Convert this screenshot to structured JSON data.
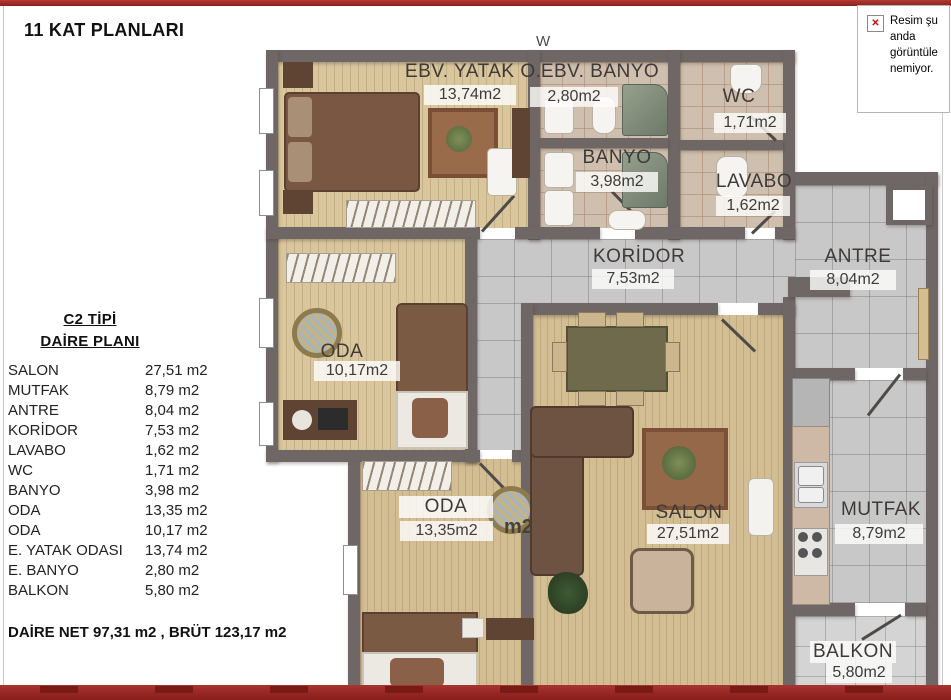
{
  "page": {
    "title": "11 KAT PLANLARI"
  },
  "broken_image_notice": {
    "text": "Resim şu anda görüntüle nemiyor.",
    "icon": "broken-image-x"
  },
  "info_panel": {
    "heading_line1": "C2 TİPİ",
    "heading_line2": "DAİRE PLANI",
    "rooms": [
      {
        "name": "SALON",
        "area": "27,51 m2"
      },
      {
        "name": "MUTFAK",
        "area": "8,79 m2"
      },
      {
        "name": "ANTRE",
        "area": "8,04 m2"
      },
      {
        "name": "KORİDOR",
        "area": "7,53 m2"
      },
      {
        "name": "LAVABO",
        "area": "1,62 m2"
      },
      {
        "name": "WC",
        "area": "1,71 m2"
      },
      {
        "name": "BANYO",
        "area": "3,98 m2"
      },
      {
        "name": "ODA",
        "area": "13,35 m2"
      },
      {
        "name": "ODA",
        "area": "10,17 m2"
      },
      {
        "name": "E. YATAK ODASI",
        "area": "13,74 m2"
      },
      {
        "name": "E. BANYO",
        "area": "2,80 m2"
      },
      {
        "name": "BALKON",
        "area": "5,80 m2"
      }
    ],
    "totals": "DAİRE NET 97,31 m2 , BRÜT 123,17 m2"
  },
  "plan": {
    "rooms": [
      {
        "name": "EBV. YATAK O.",
        "area": "13,74m2"
      },
      {
        "name": "EBV. BANYO",
        "area": "2,80m2"
      },
      {
        "name": "WC",
        "area": "1,71m2"
      },
      {
        "name": "BANYO",
        "area": "3,98m2"
      },
      {
        "name": "LAVABO",
        "area": "1,62m2"
      },
      {
        "name": "KORİDOR",
        "area": "7,53m2"
      },
      {
        "name": "ANTRE",
        "area": "8,04m2"
      },
      {
        "name": "ODA",
        "area": "10,17m2"
      },
      {
        "name": "ODA",
        "area": "13,35m2"
      },
      {
        "name": "SALON",
        "area": "27,51m2"
      },
      {
        "name": "MUTFAK",
        "area": "8,79m2"
      },
      {
        "name": "BALKON",
        "area": "5,80m2"
      }
    ],
    "stray_label": "m2",
    "top_partial_label": "W"
  },
  "colors": {
    "accent_red": "#9c2822",
    "wall": "#6e6765",
    "wood_floor": "#d9c69c",
    "bath_tile": "#cfbfae",
    "gray_tile": "#c8c8c8"
  }
}
